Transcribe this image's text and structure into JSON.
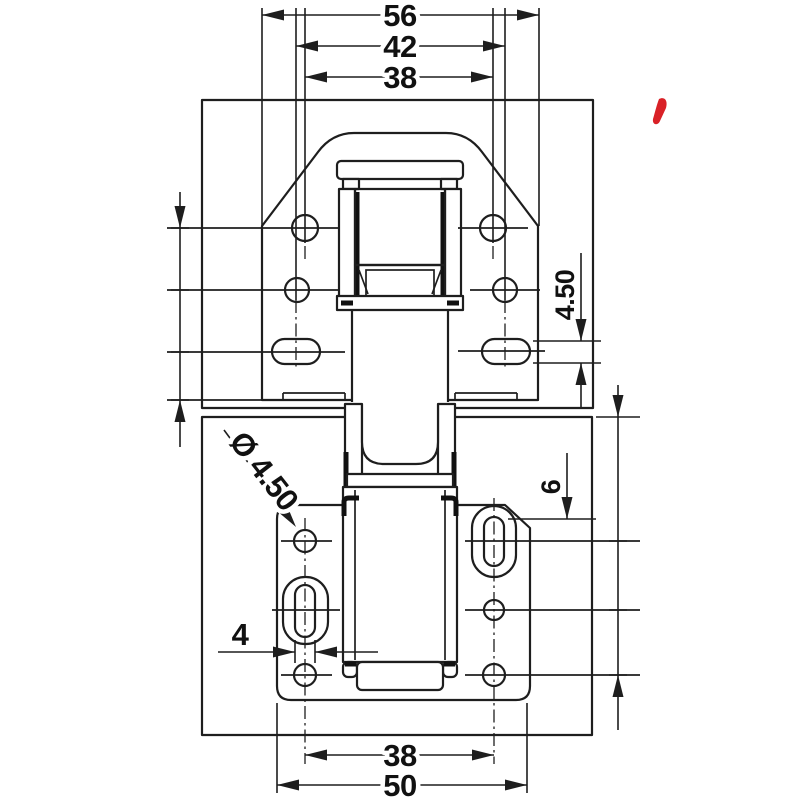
{
  "drawing": {
    "dimensions": {
      "top": {
        "overall": "56",
        "slot_centers": "42",
        "hole_centers": "38"
      },
      "left_chain": "10 • 12 • 12",
      "flange_slot_height": "4.50",
      "plate_slot_offset": "6",
      "right_chain": "13 • 14 • 25.50",
      "hole_diameter": "Ø 4.50",
      "plate_slot_width": "4",
      "bottom": {
        "hole_centers": "38",
        "plate_width": "50"
      }
    },
    "colors": {
      "ink": "#1e1e1e",
      "red_mark": "#d92127",
      "panel_fill": "#fcfcfc",
      "part_fill": "#ffffff"
    }
  }
}
